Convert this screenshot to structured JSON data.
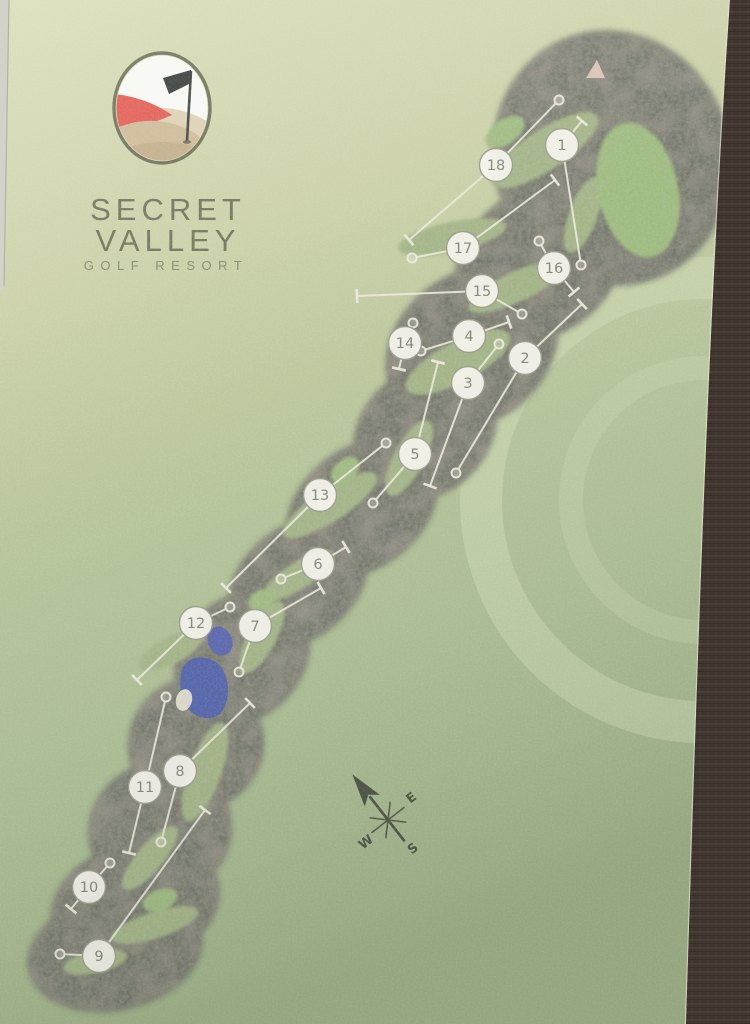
{
  "poster": {
    "type": "golf-course-map-poster",
    "logo": {
      "icon": "golf-flag-hills-logo",
      "title_line1": "SECRET",
      "title_line2": "VALLEY",
      "subtitle": "GOLF RESORT"
    },
    "compass": {
      "icon": "compass-rose-north-arrow",
      "east": "E",
      "west": "W",
      "south": "S"
    },
    "colors": {
      "paper_top": "#dadcb8",
      "paper_bottom": "#a2b48c",
      "rough": "#73766a",
      "fairway": "#a2b483",
      "green": "#9cbc7a",
      "lake": "#5565ac",
      "line": "#ece9dc",
      "badge_fill": "#f4f3ec",
      "badge_stroke": "#9a9d8c",
      "wall": "#4a3e37",
      "logo_red": "#e15a51"
    }
  },
  "course": {
    "holes": [
      {
        "number": "1",
        "badge": [
          562,
          145
        ],
        "circle_end": [
          581,
          265
        ],
        "tbar_end": [
          582,
          121
        ]
      },
      {
        "number": "2",
        "badge": [
          525,
          358
        ],
        "circle_end": [
          456,
          473
        ],
        "tbar_end": [
          582,
          304
        ]
      },
      {
        "number": "3",
        "badge": [
          468,
          383
        ],
        "circle_end": [
          499,
          344
        ],
        "tbar_end": [
          430,
          486
        ]
      },
      {
        "number": "4",
        "badge": [
          469,
          336
        ],
        "circle_end": [
          421,
          351
        ],
        "tbar_end": [
          509,
          322
        ]
      },
      {
        "number": "5",
        "badge": [
          415,
          454
        ],
        "circle_end": [
          373,
          503
        ],
        "tbar_end": [
          438,
          362
        ]
      },
      {
        "number": "6",
        "badge": [
          318,
          564
        ],
        "circle_end": [
          281,
          579
        ],
        "tbar_end": [
          346,
          547
        ]
      },
      {
        "number": "7",
        "badge": [
          255,
          626
        ],
        "circle_end": [
          239,
          672
        ],
        "tbar_end": [
          321,
          588
        ]
      },
      {
        "number": "8",
        "badge": [
          180,
          771
        ],
        "circle_end": [
          161,
          842
        ],
        "tbar_end": [
          250,
          703
        ]
      },
      {
        "number": "9",
        "badge": [
          99,
          956
        ],
        "circle_end": [
          60,
          954
        ],
        "tbar_end": [
          205,
          810
        ]
      },
      {
        "number": "10",
        "badge": [
          89,
          887
        ],
        "circle_end": [
          110,
          863
        ],
        "tbar_end": [
          71,
          909
        ]
      },
      {
        "number": "11",
        "badge": [
          145,
          787
        ],
        "circle_end": [
          166,
          697
        ],
        "tbar_end": [
          129,
          853
        ]
      },
      {
        "number": "12",
        "badge": [
          196,
          623
        ],
        "circle_end": [
          230,
          607
        ],
        "tbar_end": [
          137,
          680
        ]
      },
      {
        "number": "13",
        "badge": [
          320,
          495
        ],
        "circle_end": [
          386,
          443
        ],
        "tbar_end": [
          226,
          588
        ]
      },
      {
        "number": "14",
        "badge": [
          405,
          343
        ],
        "circle_end": [
          413,
          323
        ],
        "tbar_end": [
          399,
          369
        ]
      },
      {
        "number": "15",
        "badge": [
          482,
          291
        ],
        "circle_end": [
          522,
          314
        ],
        "tbar_end": [
          357,
          296
        ]
      },
      {
        "number": "16",
        "badge": [
          554,
          268
        ],
        "circle_end": [
          539,
          241
        ],
        "tbar_end": [
          574,
          292
        ]
      },
      {
        "number": "17",
        "badge": [
          463,
          248
        ],
        "circle_end": [
          412,
          258
        ],
        "tbar_end": [
          555,
          180
        ]
      },
      {
        "number": "18",
        "badge": [
          496,
          165
        ],
        "circle_end": [
          559,
          100
        ],
        "tbar_end": [
          409,
          240
        ]
      }
    ]
  }
}
